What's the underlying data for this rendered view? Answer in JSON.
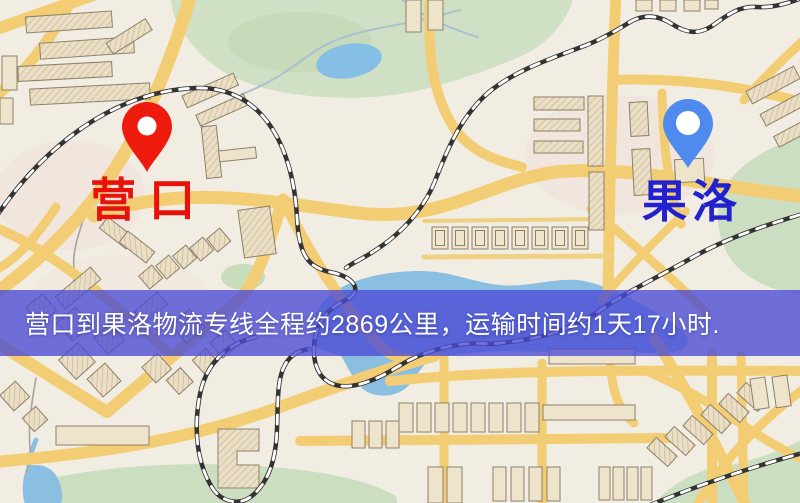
{
  "map": {
    "origin": {
      "name": "营口",
      "pin_color": "#ee1a0e",
      "label_color": "#e8120b"
    },
    "destination": {
      "name": "果洛",
      "pin_color": "#4f8bee",
      "label_color": "#2121cd"
    },
    "banner": {
      "text": "营口到果洛物流专线全程约2869公里，运输时间约1天17小时.",
      "background_color": "#4a4ad5",
      "text_color": "#ffffff"
    },
    "route": {
      "from": "营口",
      "to": "果洛",
      "distance_text": "约2869公里",
      "duration_text": "约1天17小时"
    },
    "map_colors": {
      "road": "#f2cd74",
      "railway": "#333333",
      "water": "#8abfe2",
      "park": "#cfe0c4",
      "building": "#ece1c8",
      "background": "#f2ede2"
    }
  }
}
